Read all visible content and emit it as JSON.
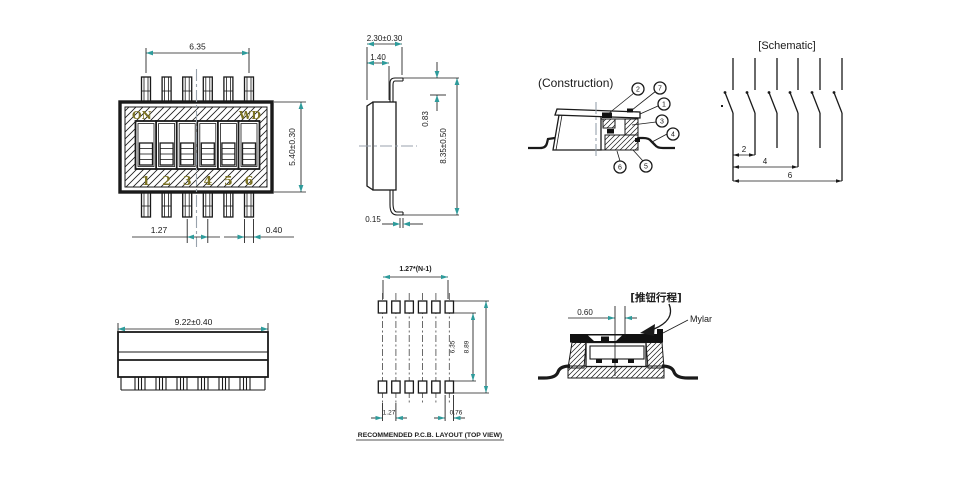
{
  "colors": {
    "line": "#1a1a1a",
    "arrow_accent": "#2e9b9b",
    "marking": "#7b7223",
    "centerline": "#98a2ac"
  },
  "top_view": {
    "dim_width": "6.35",
    "dim_height": "5.40±0.30",
    "dim_pitch": "1.27",
    "dim_pin_width": "0.40",
    "label_on": "ON",
    "label_brand": "WD",
    "switch_numbers": [
      "1",
      "2",
      "3",
      "4",
      "5",
      "6"
    ]
  },
  "side_view": {
    "dim_total_width": "2.30±0.30",
    "dim_body_width": "1.40",
    "dim_lead_height": "0.83",
    "dim_lead_span": "8.35±0.50",
    "dim_lead_thickness": "0.15"
  },
  "construction_view": {
    "title": "(Construction)",
    "callouts": [
      "1",
      "2",
      "3",
      "4",
      "5",
      "6",
      "7"
    ]
  },
  "schematic_view": {
    "title": "[Schematic]",
    "position_labels": [
      "2",
      "4",
      "6"
    ]
  },
  "front_view": {
    "dim_length": "9.22±0.40"
  },
  "pcb_layout": {
    "dim_pitch_total": "1.27*(N-1)",
    "dim_inner_span": "6.35",
    "dim_outer_span": "8.89",
    "dim_pitch": "1.27",
    "dim_pad_width": "0.76",
    "caption": "RECOMMENDED P.C.B. LAYOUT (TOP VIEW)"
  },
  "travel_view": {
    "dim_travel": "0.60",
    "label_travel": "[推钮行程]",
    "label_mylar": "Mylar"
  }
}
